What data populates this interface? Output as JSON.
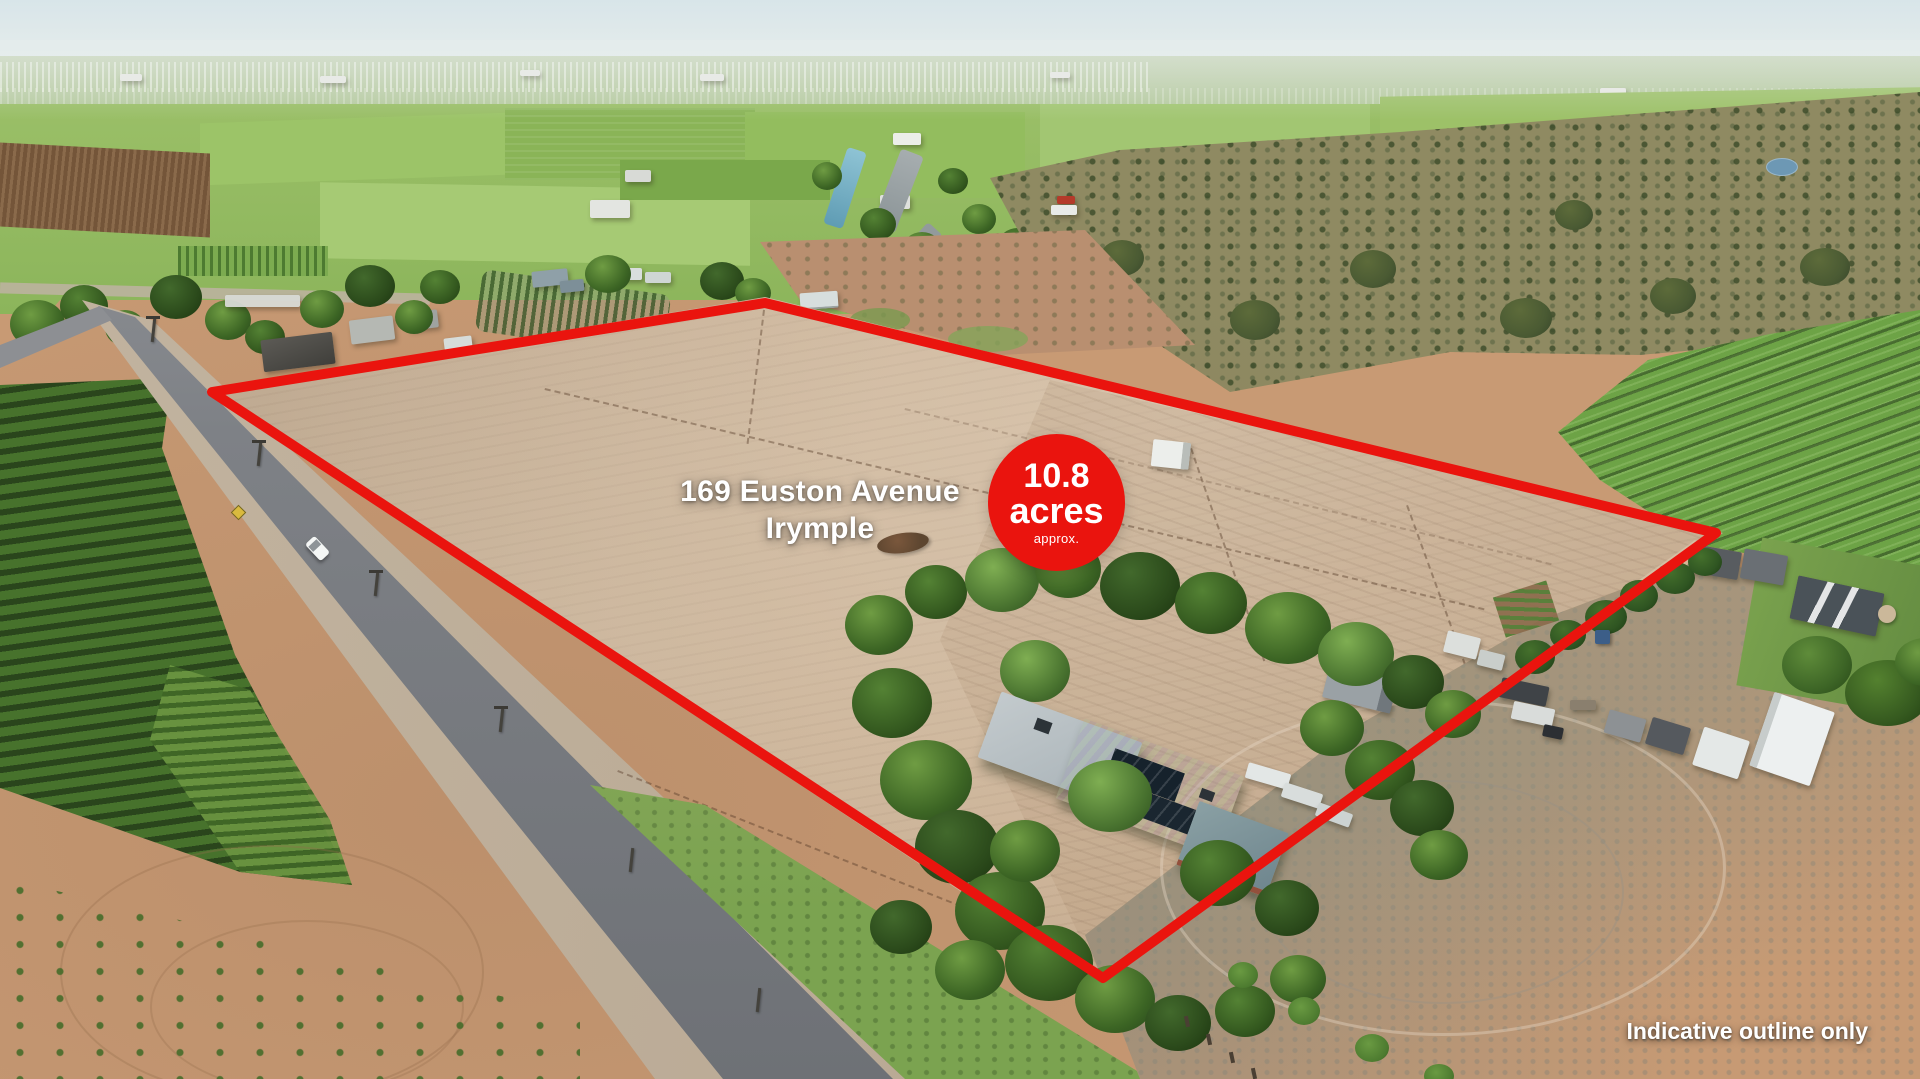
{
  "overlay": {
    "address_line1": "169 Euston Avenue",
    "address_line2": "Irymple",
    "area_badge": {
      "value": "10.8",
      "unit": "acres",
      "qualifier": "approx."
    },
    "disclaimer": "Indicative outline only",
    "outline_points": "212,392 765,303 1716,533 1103,978",
    "colors": {
      "accent_red": "#EA140E",
      "text_white": "#FFFFFF"
    }
  }
}
